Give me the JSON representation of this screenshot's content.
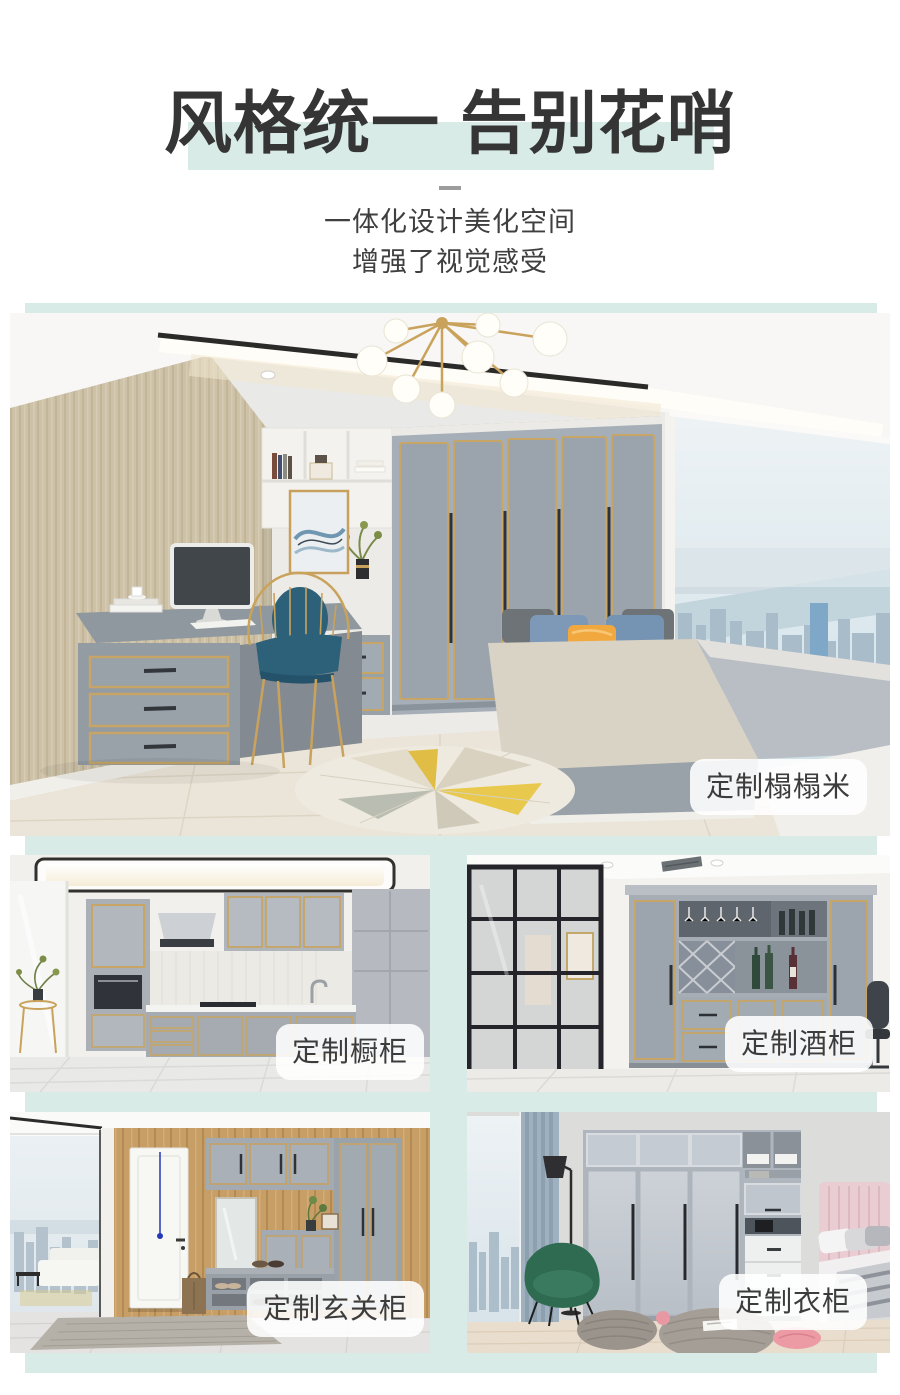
{
  "header": {
    "title": "风格统一 告别花哨",
    "subtitle_line1": "一体化设计美化空间",
    "subtitle_line2": "增强了视觉感受"
  },
  "gallery": {
    "hero": {
      "label": "定制榻榻米"
    },
    "items": [
      {
        "label": "定制橱柜"
      },
      {
        "label": "定制酒柜"
      },
      {
        "label": "定制玄关柜"
      },
      {
        "label": "定制衣柜"
      }
    ]
  },
  "colors": {
    "accent_mint": "#d8ebe6",
    "title_text": "#353535",
    "label_text": "#3c3c3c"
  }
}
